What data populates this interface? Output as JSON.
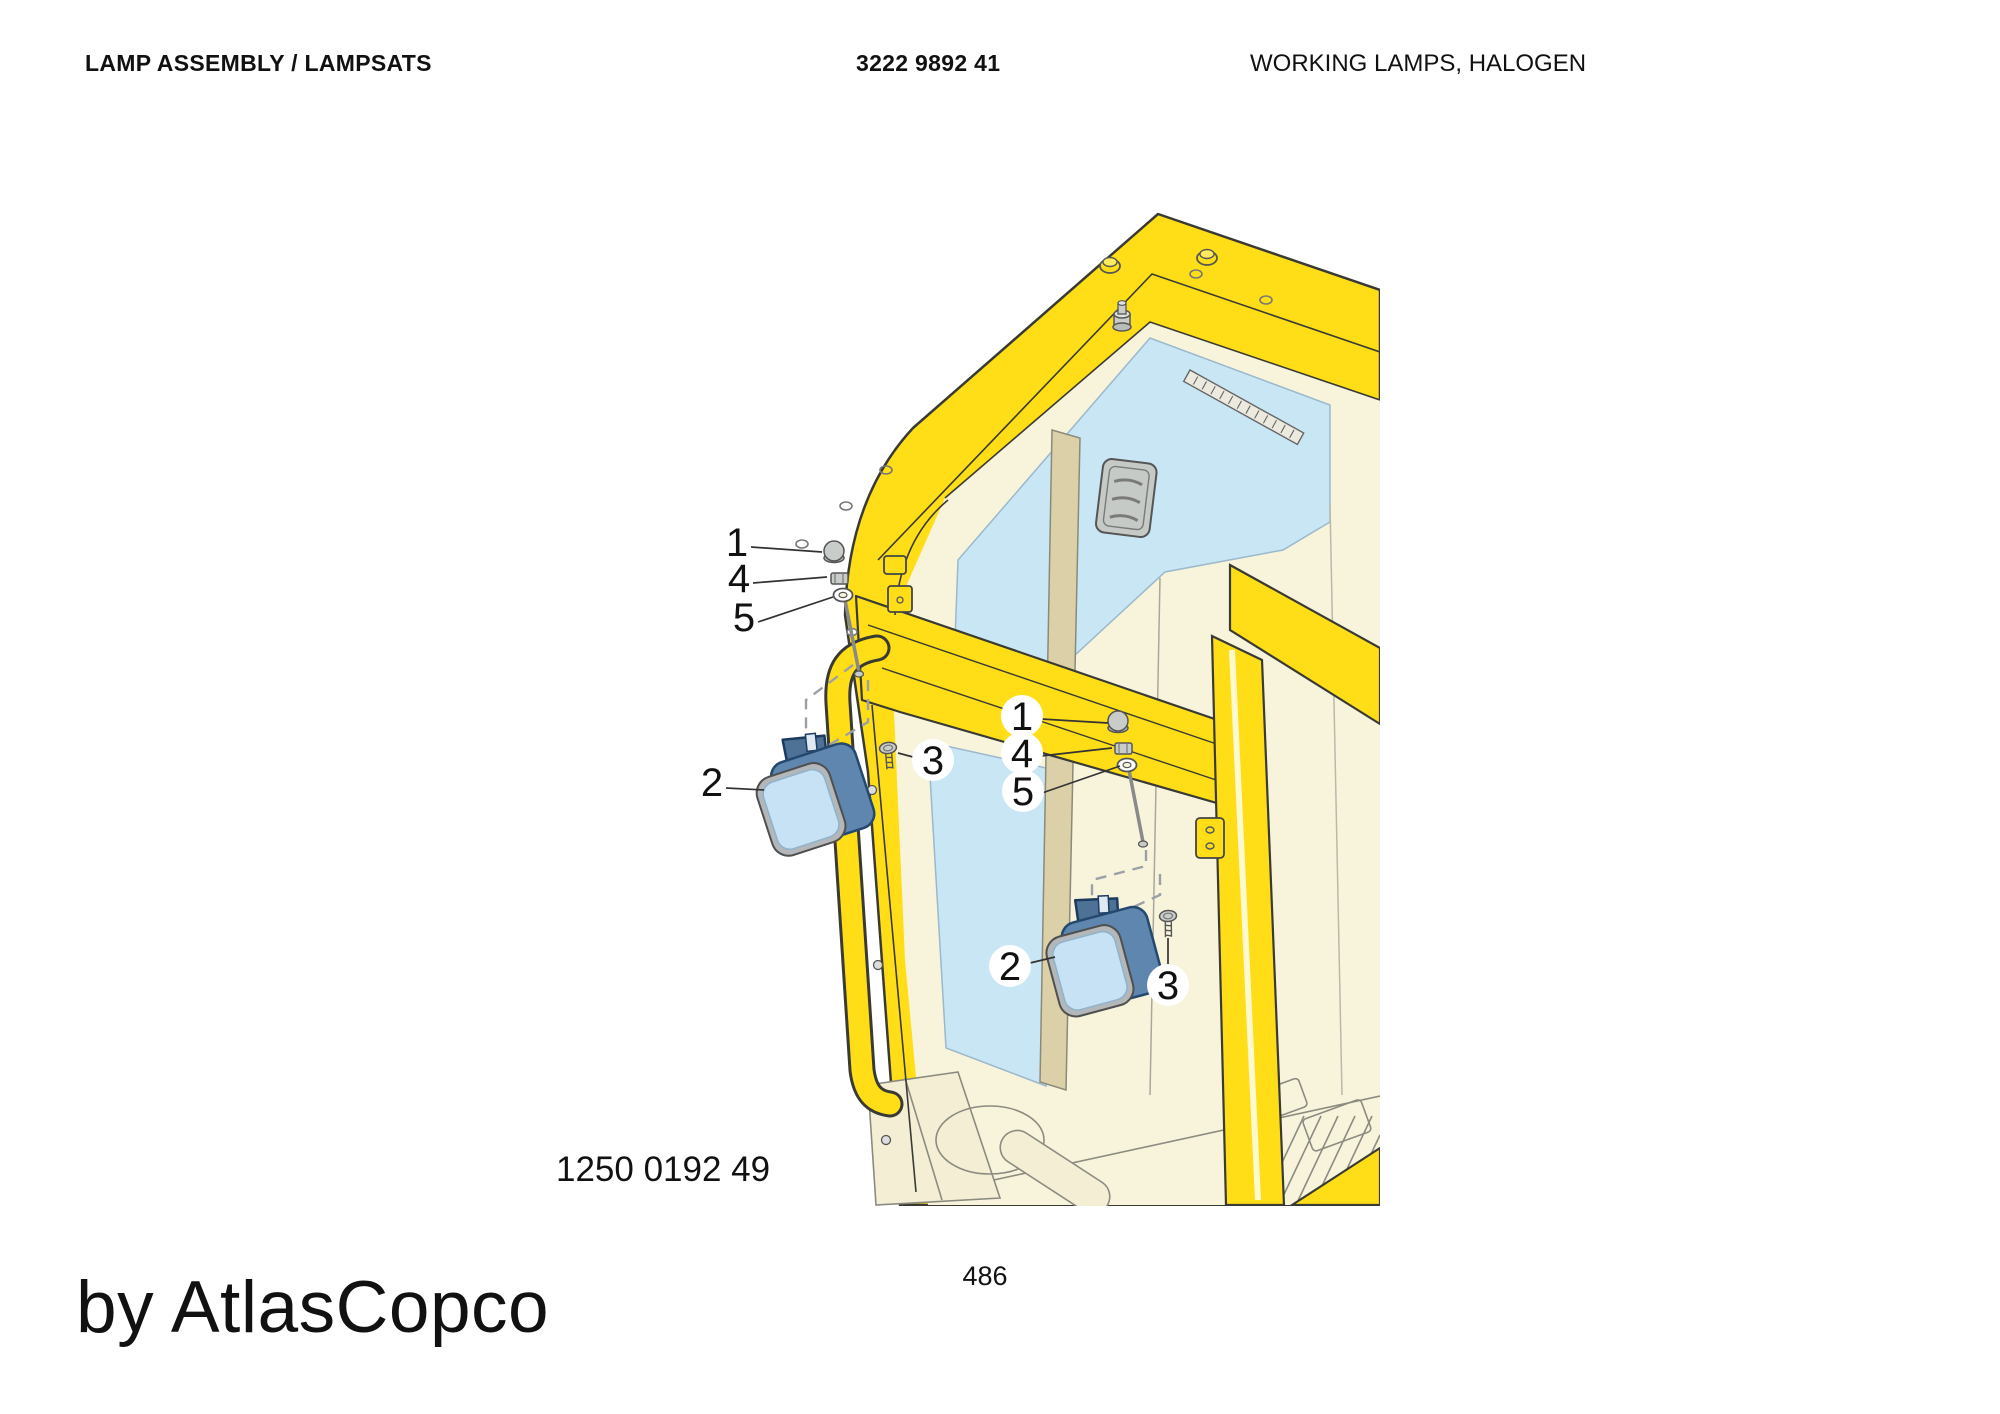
{
  "header": {
    "title": "LAMP ASSEMBLY / LAMPSATS",
    "part_number": "3222 9892 41",
    "subtitle": "WORKING LAMPS, HALOGEN"
  },
  "footer": {
    "drawing_number": "1250 0192 49",
    "page_number": "486",
    "watermark": "by AtlasCopco"
  },
  "diagram": {
    "description": "Exploded view of halogen working lamps mounted on cab front frame",
    "callouts": {
      "upper_fastener_group": {
        "cap_nut": "1",
        "nut": "4",
        "washer": "5"
      },
      "lower_fastener_group": {
        "cap_nut": "1",
        "nut": "4",
        "washer": "5"
      },
      "upper_lamp": {
        "lamp": "2",
        "screw": "3"
      },
      "lower_lamp": {
        "lamp": "2",
        "screw": "3"
      }
    },
    "colors": {
      "cab_yellow": "#FFDE17",
      "glass_blue": "#C9E6F5",
      "interior_cream": "#F8F4DC",
      "trim_tan": "#DCD0A8",
      "lamp_body_blue": "#5E86AE",
      "lamp_lens_blue": "#C6E2F4",
      "hardware_gray": "#C9CDC9"
    }
  }
}
